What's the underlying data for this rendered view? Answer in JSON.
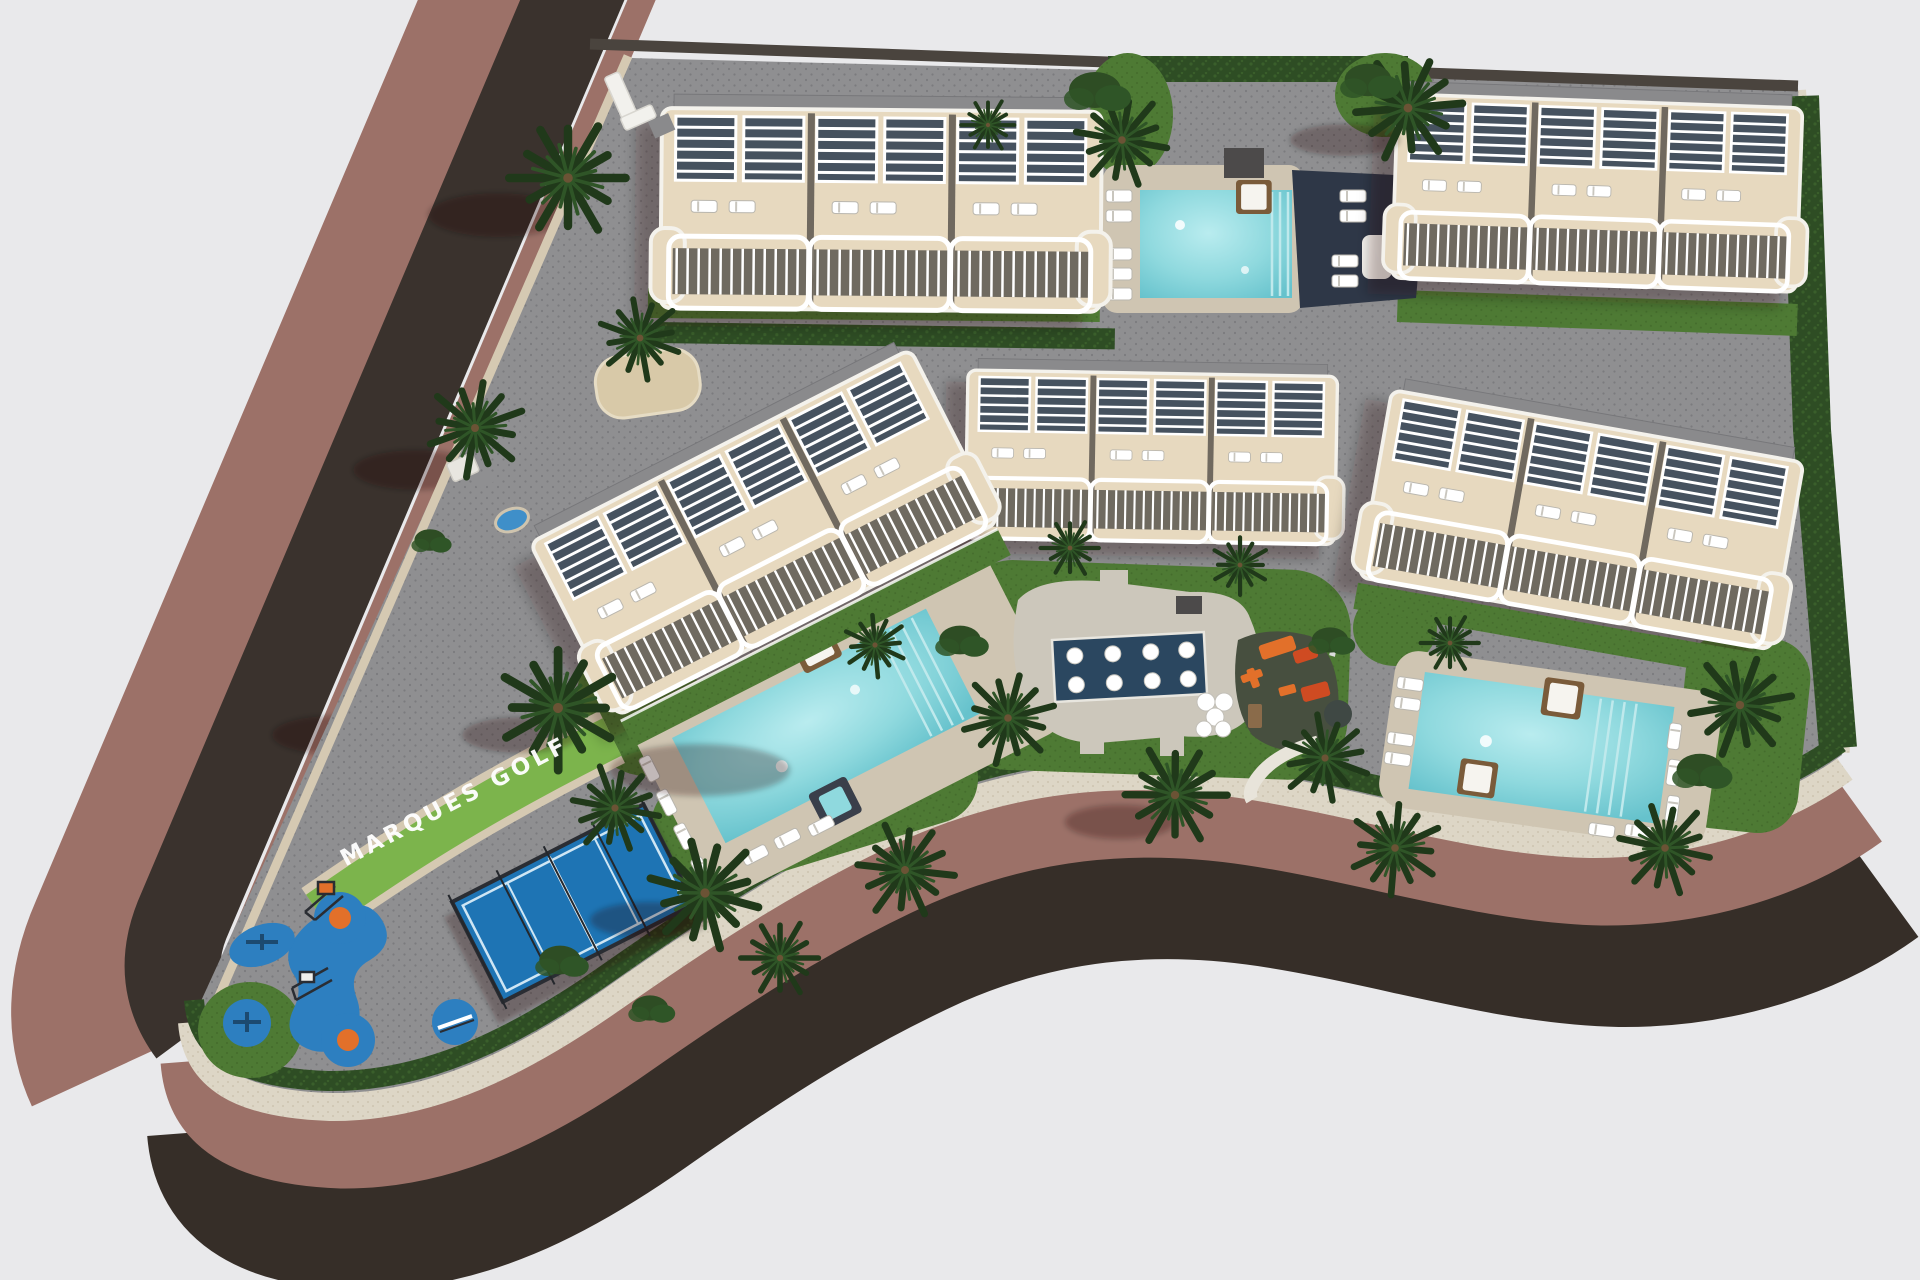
{
  "site": {
    "label": "MARQUES GOLF",
    "stats": {
      "residential_blocks": 5,
      "swimming_pools": 3,
      "spa_pool": 1,
      "padel_courts": 1,
      "playgrounds": 2
    }
  },
  "palette": {
    "background": "#e9e9eb",
    "asphalt": "#3a322d",
    "embankment": "#362e28",
    "sidewalk": "#9c7168",
    "curb": "#d5c9b2",
    "pavers": "#8f8f91",
    "paver_dot": "#7b7b7e",
    "lawn": "#4e7a34",
    "lawn_dark": "#446c2c",
    "lawn_light": "#7cb44c",
    "hedge": "#2e4d24",
    "hedge_dot": "#3a5f2b",
    "gravel": "#ddd6c6",
    "gravel_dot": "#c9bfa9",
    "deck": "#cfc5b2",
    "pool_water_hi": "#b9ecef",
    "pool_water": "#8fd9de",
    "pool_water_lo": "#66c2cc",
    "spa_water": "#2b4760",
    "navy_deck": "#2e3747",
    "building_body": "#e7d9bf",
    "building_white": "#f4f2ec",
    "facade_shade": "#6f6a60",
    "roof_gray": "#8a8a8c",
    "pergola_dark": "#46525f",
    "wall_dark": "#4a443e",
    "wood": "#7a5b3a",
    "padel_blue": "#1e74b4",
    "play_blue": "#2d7fc0",
    "play_orange": "#e2702a",
    "play_red": "#cf4b22",
    "rubber_dark": "#474f3f",
    "palm_dark": "#20391a",
    "palm_light": "#2f5527",
    "trunk": "#6b5335",
    "shadow": "rgba(20,16,12,0.28)",
    "white": "#ffffff"
  }
}
